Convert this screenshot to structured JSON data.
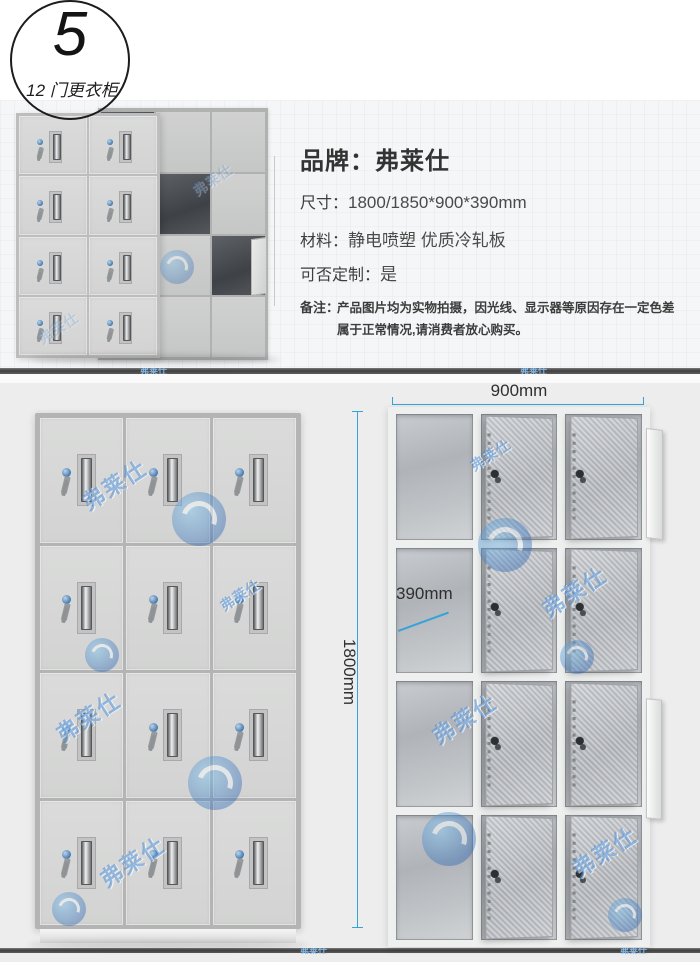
{
  "badge": {
    "number": "5",
    "label": "12 门更衣柜"
  },
  "specs": {
    "brand": {
      "label": "品牌：",
      "value": "弗莱仕"
    },
    "rows": [
      {
        "label": "尺寸：",
        "value": "1800/1850*900*390mm"
      },
      {
        "label": "材料：",
        "value": "静电喷塑 优质冷轧板"
      },
      {
        "label": "可否定制：",
        "value": "是"
      }
    ],
    "note_label": "备注：",
    "note_line1": "产品图片均为实物拍摄，因光线、显示器等原因存在一定色差",
    "note_line2": "属于正常情况,请消费者放心购买。"
  },
  "dimensions": {
    "width": "900mm",
    "height": "1800mm",
    "depth": "390mm"
  },
  "watermark": {
    "text": "弗莱仕"
  },
  "colors": {
    "accent": "#35a3da",
    "watermark_blue": "#4687cd",
    "section_bg": "#ededee"
  },
  "lockers": {
    "photo_front": {
      "rows": 4,
      "cols": 2
    },
    "photo_back": {
      "rows": 4,
      "cols": 3,
      "open_cells": [
        [
          0,
          0
        ],
        [
          1,
          1
        ],
        [
          2,
          2
        ],
        [
          3,
          0
        ]
      ]
    },
    "closed": {
      "rows": 4,
      "cols": 3
    },
    "open": {
      "rows": 4,
      "cols": 3
    }
  }
}
